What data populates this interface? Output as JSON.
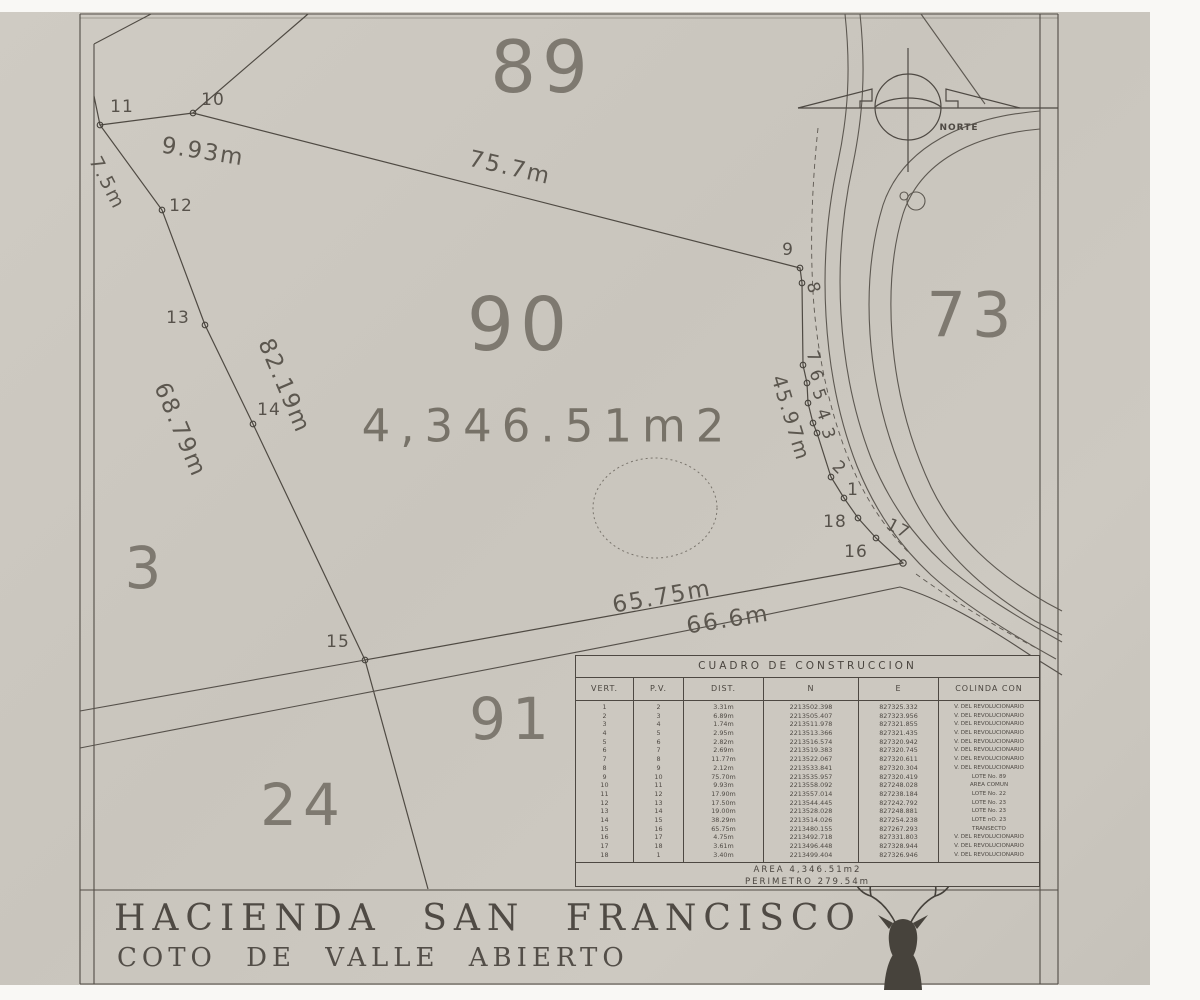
{
  "plan": {
    "north_label": "NORTE",
    "area_label": "4,346.51m2",
    "lot_numbers": [
      {
        "text": "89",
        "x": 542,
        "y": 67,
        "size": 72
      },
      {
        "text": "90",
        "x": 520,
        "y": 325,
        "size": 74
      },
      {
        "text": "73",
        "x": 972,
        "y": 315,
        "size": 62
      },
      {
        "text": "91",
        "x": 512,
        "y": 719,
        "size": 58
      },
      {
        "text": "24",
        "x": 303,
        "y": 805,
        "size": 58
      },
      {
        "text": "3",
        "x": 146,
        "y": 568,
        "size": 58
      }
    ],
    "measurements": [
      {
        "text": "9.93m",
        "x": 203,
        "y": 152,
        "rot": 9,
        "size": 23
      },
      {
        "text": "7.5m",
        "x": 107,
        "y": 183,
        "rot": 63,
        "size": 19
      },
      {
        "text": "75.7m",
        "x": 510,
        "y": 168,
        "rot": 13,
        "size": 23
      },
      {
        "text": "82.19m",
        "x": 284,
        "y": 386,
        "rot": 67,
        "size": 23
      },
      {
        "text": "68.79m",
        "x": 180,
        "y": 430,
        "rot": 67,
        "size": 23
      },
      {
        "text": "45.97m",
        "x": 791,
        "y": 418,
        "rot": 73,
        "size": 20
      },
      {
        "text": "65.75m",
        "x": 662,
        "y": 597,
        "rot": -10,
        "size": 23
      },
      {
        "text": "66.6m",
        "x": 728,
        "y": 620,
        "rot": -9,
        "size": 23
      }
    ],
    "vertex_labels": [
      {
        "text": "11",
        "x": 122,
        "y": 107,
        "rot": 0
      },
      {
        "text": "10",
        "x": 213,
        "y": 100,
        "rot": 0
      },
      {
        "text": "12",
        "x": 181,
        "y": 206,
        "rot": 0
      },
      {
        "text": "13",
        "x": 178,
        "y": 318,
        "rot": 0
      },
      {
        "text": "14",
        "x": 269,
        "y": 410,
        "rot": 0
      },
      {
        "text": "15",
        "x": 338,
        "y": 642,
        "rot": 0
      },
      {
        "text": "9",
        "x": 788,
        "y": 250,
        "rot": 0
      },
      {
        "text": "8",
        "x": 813,
        "y": 288,
        "rot": 75
      },
      {
        "text": "7",
        "x": 813,
        "y": 357,
        "rot": 70
      },
      {
        "text": "6",
        "x": 816,
        "y": 376,
        "rot": 70
      },
      {
        "text": "5",
        "x": 819,
        "y": 395,
        "rot": 70
      },
      {
        "text": "4",
        "x": 823,
        "y": 415,
        "rot": 70
      },
      {
        "text": "3",
        "x": 828,
        "y": 434,
        "rot": 70
      },
      {
        "text": "2",
        "x": 839,
        "y": 468,
        "rot": 45
      },
      {
        "text": "1",
        "x": 853,
        "y": 490,
        "rot": 0
      },
      {
        "text": "18",
        "x": 835,
        "y": 522,
        "rot": 0
      },
      {
        "text": "17",
        "x": 898,
        "y": 529,
        "rot": 28
      },
      {
        "text": "16",
        "x": 856,
        "y": 552,
        "rot": 0
      }
    ]
  },
  "table": {
    "title": "CUADRO DE CONSTRUCCION",
    "columns": [
      "VERT.",
      "P.V.",
      "DIST.",
      "N",
      "E",
      "COLINDA CON"
    ],
    "rows": [
      [
        "1",
        "2",
        "3.31m",
        "2213502.398",
        "827325.332",
        "V. DEL REVOLUCIONARIO"
      ],
      [
        "2",
        "3",
        "6.89m",
        "2213505.407",
        "827323.956",
        "V. DEL REVOLUCIONARIO"
      ],
      [
        "3",
        "4",
        "1.74m",
        "2213511.978",
        "827321.855",
        "V. DEL REVOLUCIONARIO"
      ],
      [
        "4",
        "5",
        "2.95m",
        "2213513.366",
        "827321.435",
        "V. DEL REVOLUCIONARIO"
      ],
      [
        "5",
        "6",
        "2.82m",
        "2213516.574",
        "827320.942",
        "V. DEL REVOLUCIONARIO"
      ],
      [
        "6",
        "7",
        "2.69m",
        "2213519.383",
        "827320.745",
        "V. DEL REVOLUCIONARIO"
      ],
      [
        "7",
        "8",
        "11.77m",
        "2213522.067",
        "827320.611",
        "V. DEL REVOLUCIONARIO"
      ],
      [
        "8",
        "9",
        "2.12m",
        "2213533.841",
        "827320.304",
        "V. DEL REVOLUCIONARIO"
      ],
      [
        "9",
        "10",
        "75.70m",
        "2213535.957",
        "827320.419",
        "LOTE No. 89"
      ],
      [
        "10",
        "11",
        "9.93m",
        "2213558.092",
        "827248.028",
        "AREA COMUN"
      ],
      [
        "11",
        "12",
        "17.90m",
        "2213557.014",
        "827238.184",
        "LOTE No. 22"
      ],
      [
        "12",
        "13",
        "17.50m",
        "2213544.445",
        "827242.792",
        "LOTE No. 23"
      ],
      [
        "13",
        "14",
        "19.00m",
        "2213528.028",
        "827248.881",
        "LOTE No. 23"
      ],
      [
        "14",
        "15",
        "38.29m",
        "2213514.026",
        "827254.238",
        "LOTE nO. 23"
      ],
      [
        "15",
        "16",
        "65.75m",
        "2213480.155",
        "827267.293",
        "TRANSECTO"
      ],
      [
        "16",
        "17",
        "4.75m",
        "2213492.718",
        "827331.803",
        "V. DEL REVOLUCIONARIO"
      ],
      [
        "17",
        "18",
        "3.61m",
        "2213496.448",
        "827328.944",
        "V. DEL REVOLUCIONARIO"
      ],
      [
        "18",
        "1",
        "3.40m",
        "2213499.404",
        "827326.946",
        "V. DEL REVOLUCIONARIO"
      ]
    ],
    "area_row": "AREA  4,346.51m2",
    "perimeter_row": "PERIMETRO  279.54m"
  },
  "title_block": {
    "line1": "HACIENDA SAN FRANCISCO",
    "line2": "COTO DE VALLE ABIERTO"
  },
  "colors": {
    "paper": "#ccc8c0",
    "ink": "#57524b",
    "light_ink": "#7e7970"
  }
}
